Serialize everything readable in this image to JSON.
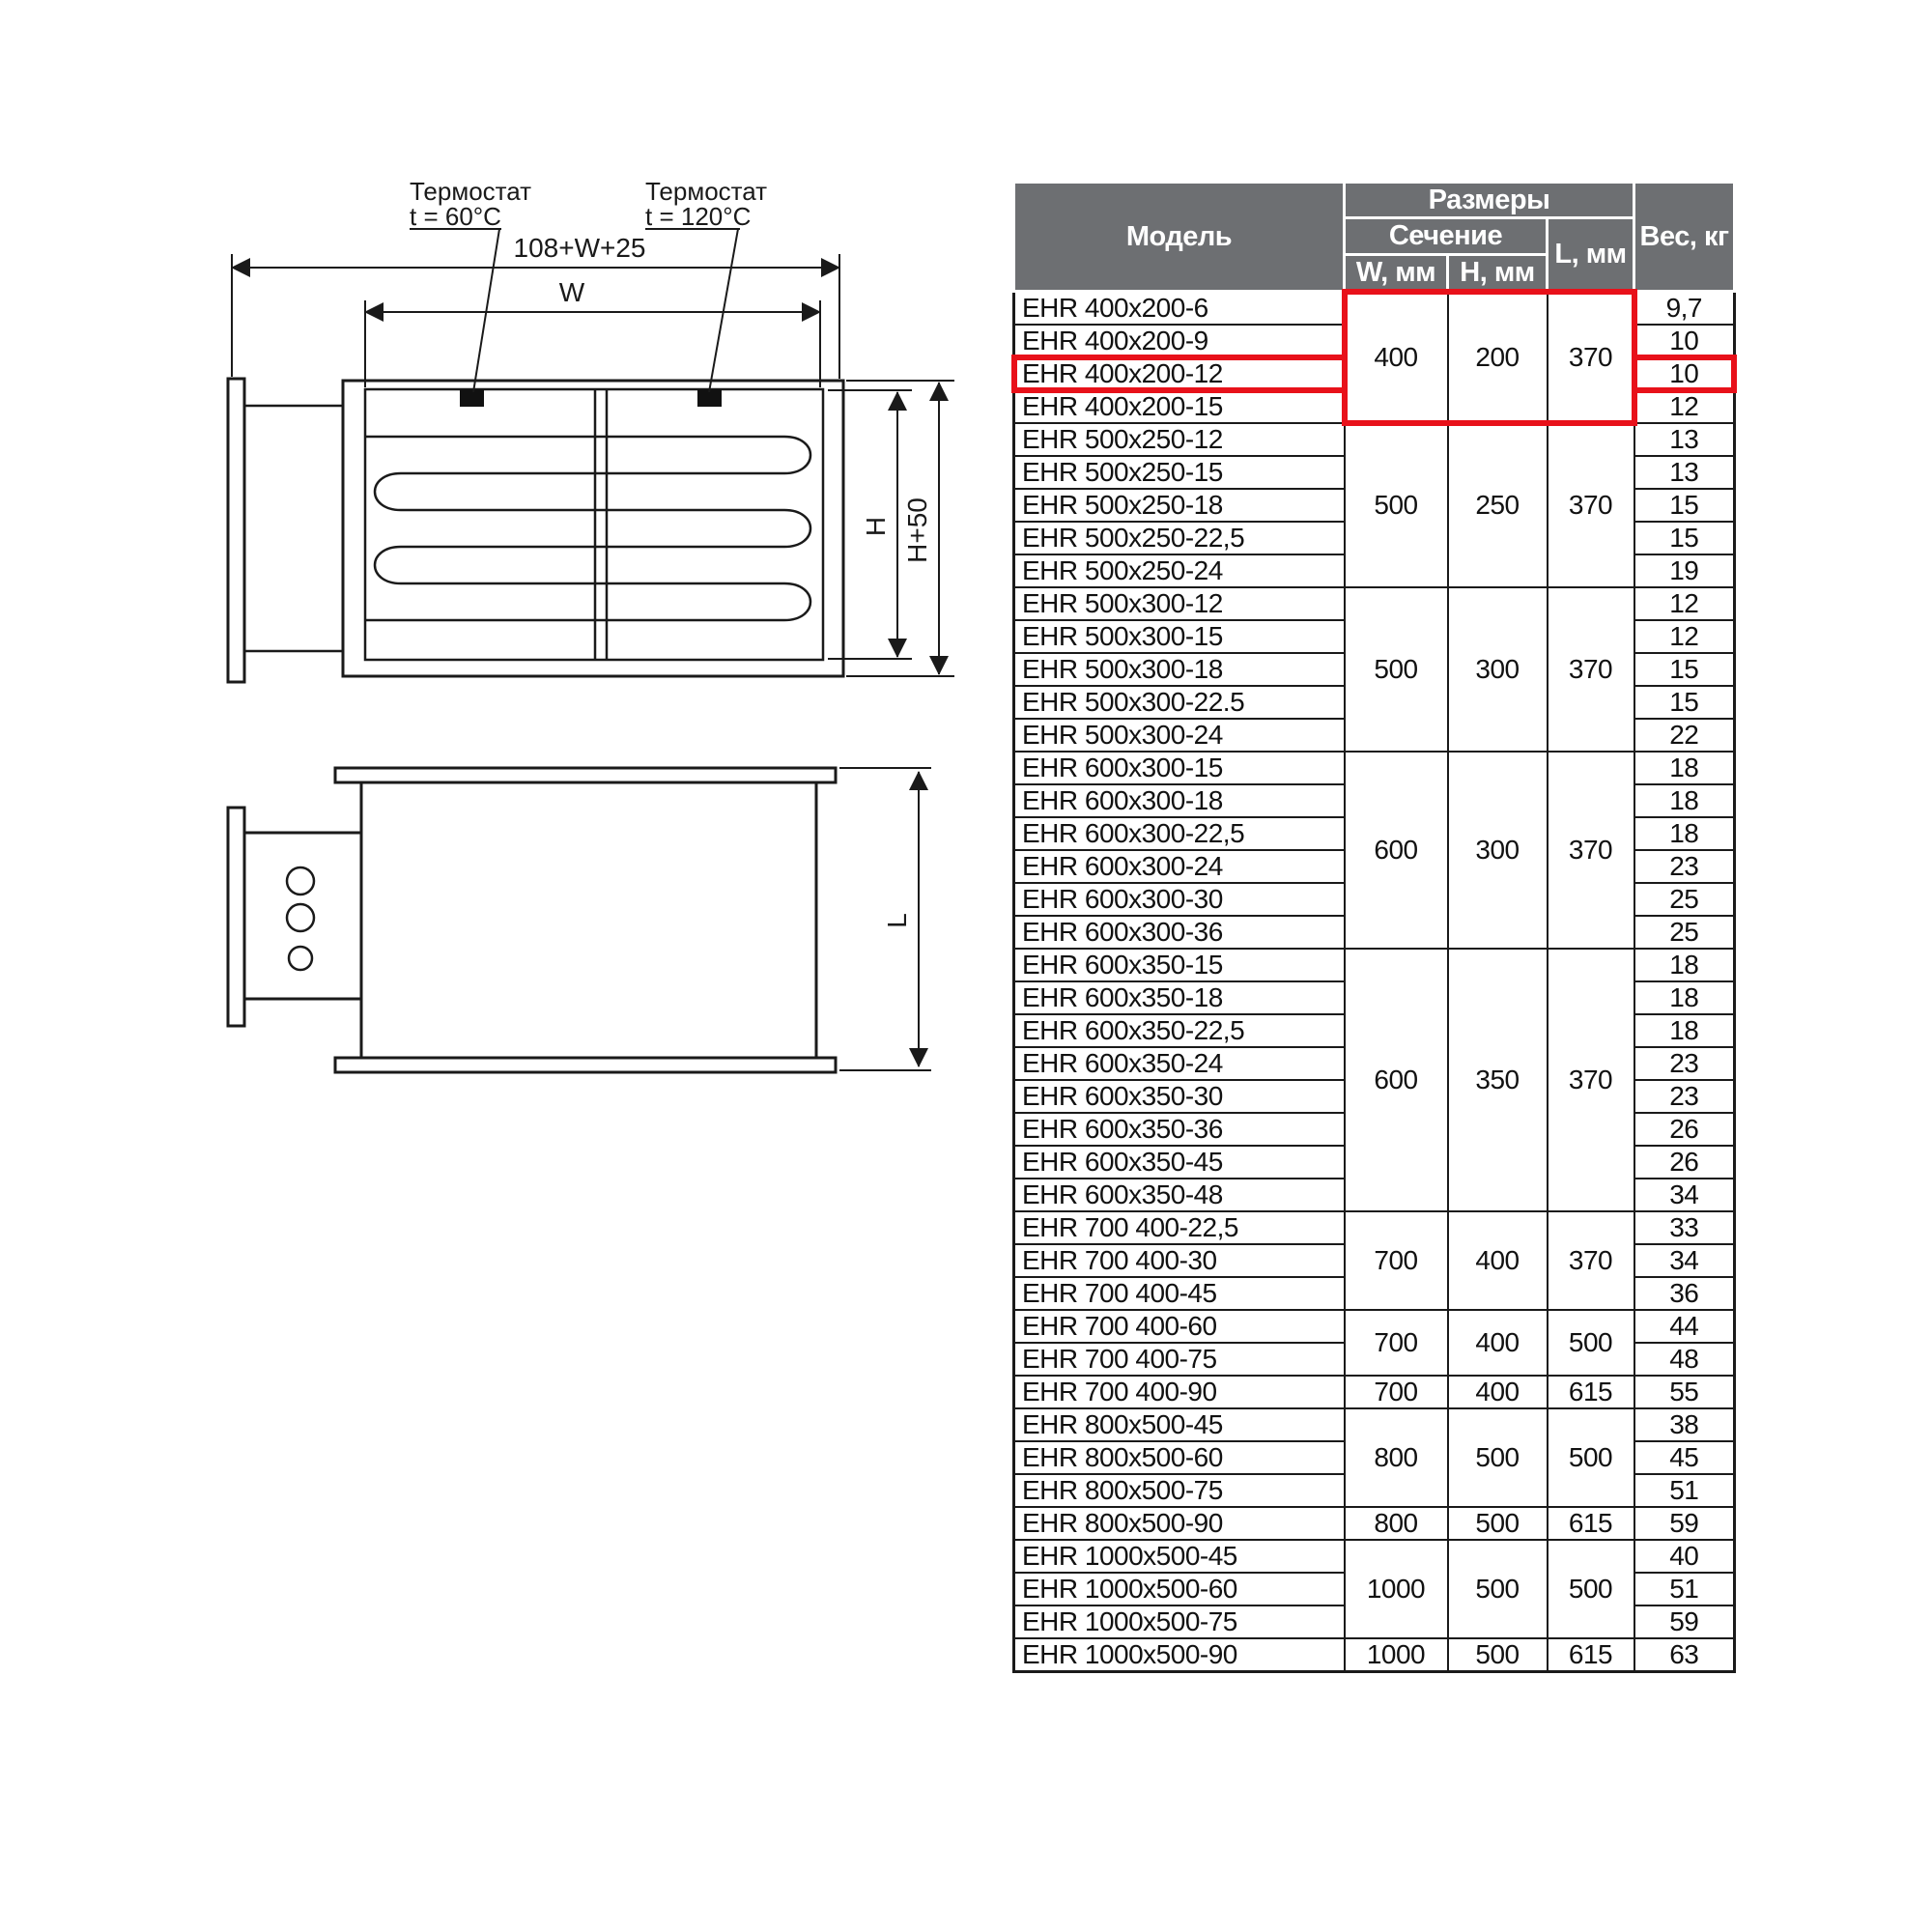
{
  "diagram": {
    "thermostat1_title": "Термостат",
    "thermostat1_value": "t = 60°C",
    "thermostat2_title": "Термостат",
    "thermostat2_value": "t = 120°C",
    "dim_total_width": "108+W+25",
    "dim_width": "W",
    "dim_height": "H",
    "dim_height_outer": "H+50",
    "dim_length": "L"
  },
  "colors": {
    "header_bg": "#6d6f72",
    "highlight_red": "#e8111a",
    "line": "#1a1a1a"
  },
  "table": {
    "header": {
      "model": "Модель",
      "dimensions": "Размеры",
      "section": "Сечение",
      "w": "W, мм",
      "h": "H, мм",
      "l": "L, мм",
      "weight": "Вес, кг"
    },
    "groups": [
      {
        "w": "400",
        "h": "200",
        "l": "370",
        "dims_highlighted": true,
        "rows": [
          {
            "model": "EHR 400x200-6",
            "weight": "9,7"
          },
          {
            "model": "EHR 400x200-9",
            "weight": "10"
          },
          {
            "model": "EHR 400x200-12",
            "weight": "10",
            "highlighted": true
          },
          {
            "model": "EHR 400x200-15",
            "weight": "12"
          }
        ]
      },
      {
        "w": "500",
        "h": "250",
        "l": "370",
        "rows": [
          {
            "model": "EHR 500x250-12",
            "weight": "13"
          },
          {
            "model": "EHR 500x250-15",
            "weight": "13"
          },
          {
            "model": "EHR 500x250-18",
            "weight": "15"
          },
          {
            "model": "EHR 500x250-22,5",
            "weight": "15"
          },
          {
            "model": "EHR 500x250-24",
            "weight": "19"
          }
        ]
      },
      {
        "w": "500",
        "h": "300",
        "l": "370",
        "rows": [
          {
            "model": "EHR 500x300-12",
            "weight": "12"
          },
          {
            "model": "EHR 500x300-15",
            "weight": "12"
          },
          {
            "model": "EHR 500x300-18",
            "weight": "15"
          },
          {
            "model": "EHR 500x300-22.5",
            "weight": "15"
          },
          {
            "model": "EHR 500x300-24",
            "weight": "22"
          }
        ]
      },
      {
        "w": "600",
        "h": "300",
        "l": "370",
        "rows": [
          {
            "model": "EHR 600x300-15",
            "weight": "18"
          },
          {
            "model": "EHR 600x300-18",
            "weight": "18"
          },
          {
            "model": "EHR 600x300-22,5",
            "weight": "18"
          },
          {
            "model": "EHR 600x300-24",
            "weight": "23"
          },
          {
            "model": "EHR 600x300-30",
            "weight": "25"
          },
          {
            "model": "EHR 600x300-36",
            "weight": "25"
          }
        ]
      },
      {
        "w": "600",
        "h": "350",
        "l": "370",
        "rows": [
          {
            "model": "EHR 600x350-15",
            "weight": "18"
          },
          {
            "model": "EHR 600x350-18",
            "weight": "18"
          },
          {
            "model": "EHR 600x350-22,5",
            "weight": "18"
          },
          {
            "model": "EHR 600x350-24",
            "weight": "23"
          },
          {
            "model": "EHR 600x350-30",
            "weight": "23"
          },
          {
            "model": "EHR 600x350-36",
            "weight": "26"
          },
          {
            "model": "EHR 600x350-45",
            "weight": "26"
          },
          {
            "model": "EHR 600x350-48",
            "weight": "34"
          }
        ]
      },
      {
        "w": "700",
        "h": "400",
        "l": "370",
        "rows": [
          {
            "model": "EHR 700 400-22,5",
            "weight": "33"
          },
          {
            "model": "EHR 700 400-30",
            "weight": "34"
          },
          {
            "model": "EHR 700 400-45",
            "weight": "36"
          }
        ]
      },
      {
        "w": "700",
        "h": "400",
        "l": "500",
        "rows": [
          {
            "model": "EHR 700 400-60",
            "weight": "44"
          },
          {
            "model": "EHR 700 400-75",
            "weight": "48"
          }
        ]
      },
      {
        "w": "700",
        "h": "400",
        "l": "615",
        "rows": [
          {
            "model": "EHR 700 400-90",
            "weight": "55"
          }
        ]
      },
      {
        "w": "800",
        "h": "500",
        "l": "500",
        "rows": [
          {
            "model": "EHR 800x500-45",
            "weight": "38"
          },
          {
            "model": "EHR 800x500-60",
            "weight": "45"
          },
          {
            "model": "EHR 800x500-75",
            "weight": "51"
          }
        ]
      },
      {
        "w": "800",
        "h": "500",
        "l": "615",
        "rows": [
          {
            "model": "EHR 800x500-90",
            "weight": "59"
          }
        ]
      },
      {
        "w": "1000",
        "h": "500",
        "l": "500",
        "rows": [
          {
            "model": "EHR 1000x500-45",
            "weight": "40"
          },
          {
            "model": "EHR 1000x500-60",
            "weight": "51"
          },
          {
            "model": "EHR 1000x500-75",
            "weight": "59"
          }
        ]
      },
      {
        "w": "1000",
        "h": "500",
        "l": "615",
        "rows": [
          {
            "model": "EHR 1000x500-90",
            "weight": "63"
          }
        ]
      }
    ]
  }
}
